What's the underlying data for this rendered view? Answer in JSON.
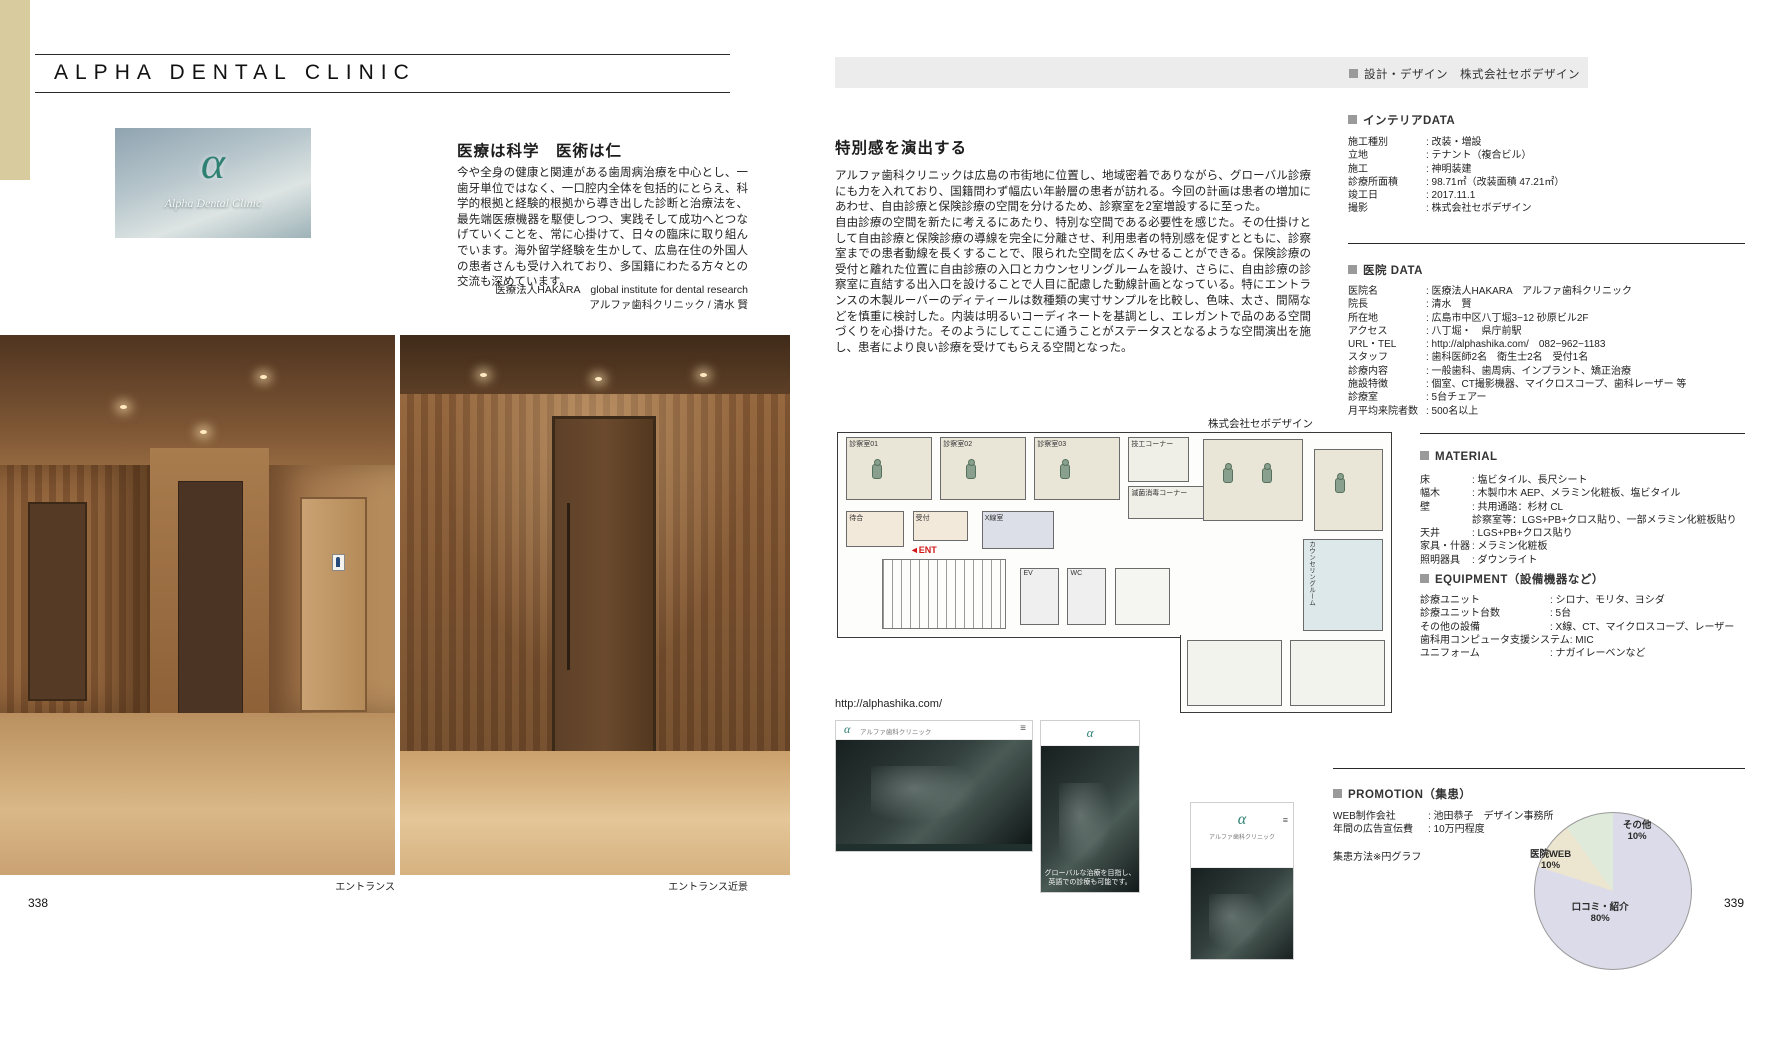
{
  "left_page": {
    "page_number": "338",
    "title": "ALPHA DENTAL CLINIC",
    "logo": {
      "alpha": "α",
      "script": "Alpha Dental Clinic"
    },
    "intro": {
      "heading": "医療は科学　医術は仁",
      "body": "今や全身の健康と関連がある歯周病治療を中心とし、一歯牙単位ではなく、一口腔内全体を包括的にとらえ、科学的根拠と経験的根拠から導き出した診断と治療法を、最先端医療機器を駆使しつつ、実践そして成功へとつなげていくことを、常に心掛けて、日々の臨床に取り組んでいます。海外留学経験を生かして、広島在住の外国人の患者さんも受け入れており、多国籍にわたる方々との交流も深めています。",
      "credit1": "医療法人HAKARA　global institute for dental research",
      "credit2": "アルファ歯科クリニック / 清水 賢"
    },
    "captions": {
      "photo1": "エントランス",
      "photo2": "エントランス近景"
    }
  },
  "right_page": {
    "page_number": "339",
    "design_credit": "設計・デザイン　株式会社セボデザイン",
    "article": {
      "heading": "特別感を演出する",
      "p1": "アルファ歯科クリニックは広島の市街地に位置し、地域密着でありながら、グローバル診療にも力を入れており、国籍問わず幅広い年齢層の患者が訪れる。今回の計画は患者の増加にあわせ、自由診療と保険診療の空間を分けるため、診察室を2室増設するに至った。",
      "p2": "自由診療の空間を新たに考えるにあたり、特別な空間である必要性を感じた。その仕掛けとして自由診療と保険診療の導線を完全に分離させ、利用患者の特別感を促すとともに、診察室までの患者動線を長くすることで、限られた空間を広くみせることができる。保険診療の受付と離れた位置に自由診療の入口とカウンセリングルームを設け、さらに、自由診療の診察室に直結する出入口を設けることで人目に配慮した動線計画となっている。特にエントランスの木製ルーバーのディティールは数種類の実寸サンプルを比較し、色味、太さ、間隔などを慎重に検討した。内装は明るいコーディネートを基調とし、エレガントで品のある空間づくりを心掛けた。そのようにしてここに通うことがステータスとなるような空間演出を施し、患者により良い診療を受けてもらえる空間となった。",
      "credit": "株式会社セボデザイン"
    },
    "floor_plan": {
      "rooms": [
        "診察室01",
        "診察室02",
        "診察室03",
        "技工コーナー",
        "滅菌消毒コーナー",
        "受付",
        "X線室",
        "待合",
        "EV",
        "WC",
        "カウンセリングルーム"
      ],
      "entrance": "ENT"
    },
    "web": {
      "url": "http://alphashika.com/",
      "logo": "α",
      "desktop_brand": "アルファ歯科クリニック",
      "menu_icon": "≡",
      "phone_caption": "グローバルな治療を目指し、\n英語での診療も可能です。"
    },
    "sections": {
      "interior": {
        "header": "インテリアDATA",
        "rows": [
          {
            "label": "施工種別",
            "value": "改装・増設"
          },
          {
            "label": "立地",
            "value": "テナント（複合ビル）"
          },
          {
            "label": "施工",
            "value": "神明装建"
          },
          {
            "label": "診療所面積",
            "value": "98.71㎡（改装面積 47.21㎡）"
          },
          {
            "label": "竣工日",
            "value": "2017.11.1"
          },
          {
            "label": "撮影",
            "value": "株式会社セボデザイン"
          }
        ]
      },
      "clinic": {
        "header": "医院 DATA",
        "rows": [
          {
            "label": "医院名",
            "value": "医療法人HAKARA　アルファ歯科クリニック"
          },
          {
            "label": "院長",
            "value": "清水　賢"
          },
          {
            "label": "所在地",
            "value": "広島市中区八丁堀3−12 砂原ビル2F"
          },
          {
            "label": "アクセス",
            "value": "八丁堀・　県庁前駅"
          },
          {
            "label": "URL・TEL",
            "value": "http://alphashika.com/　082−962−1183"
          },
          {
            "label": "スタッフ",
            "value": "歯科医師2名　衛生士2名　受付1名"
          },
          {
            "label": "診療内容",
            "value": "一般歯科、歯周病、インプラント、矯正治療"
          },
          {
            "label": "施設特徴",
            "value": "個室、CT撮影機器、マイクロスコープ、歯科レーザー 等"
          },
          {
            "label": "診療室",
            "value": "5台チェアー"
          },
          {
            "label": "月平均来院者数",
            "value": "500名以上"
          }
        ]
      },
      "material": {
        "header": "MATERIAL",
        "rows": [
          {
            "label": "床",
            "value": "塩ビタイル、長尺シート"
          },
          {
            "label": "幅木",
            "value": "木製巾木 AEP、メラミン化粧板、塩ビタイル"
          },
          {
            "label": "壁",
            "value": "共用通路：杉材 CL\n診察室等：LGS+PB+クロス貼り、一部メラミン化粧板貼り"
          },
          {
            "label": "天井",
            "value": "LGS+PB+クロス貼り"
          },
          {
            "label": "家具・什器",
            "value": "メラミン化粧板"
          },
          {
            "label": "照明器具",
            "value": "ダウンライト"
          }
        ]
      },
      "equipment": {
        "header": "EQUIPMENT（設備機器など）",
        "rows": [
          {
            "label": "診療ユニット",
            "value": "シロナ、モリタ、ヨシダ"
          },
          {
            "label": "診療ユニット台数",
            "value": "5台"
          },
          {
            "label": "その他の設備",
            "value": "X線、CT、マイクロスコープ、レーザー"
          },
          {
            "label": "歯科用コンピュータ支援システム",
            "value": "MIC"
          },
          {
            "label": "ユニフォーム",
            "value": "ナガイレーベンなど"
          }
        ]
      },
      "promotion": {
        "header": "PROMOTION（集患）",
        "rows": [
          {
            "label": "WEB制作会社",
            "value": "池田恭子　デザイン事務所"
          },
          {
            "label": "年間の広告宣伝費",
            "value": "10万円程度"
          }
        ],
        "note": "集患方法※円グラフ"
      }
    }
  },
  "chart_data": {
    "type": "pie",
    "title": "集患方法※円グラフ",
    "categories": [
      "口コミ・紹介",
      "医院WEB",
      "その他"
    ],
    "values": [
      80,
      10,
      10
    ],
    "colors": [
      "#dcdbe9",
      "#ece5cf",
      "#dfeadb"
    ],
    "labels": [
      "口コミ・紹介\n80%",
      "医院WEB\n10%",
      "その他\n10%"
    ],
    "legend": "none"
  }
}
